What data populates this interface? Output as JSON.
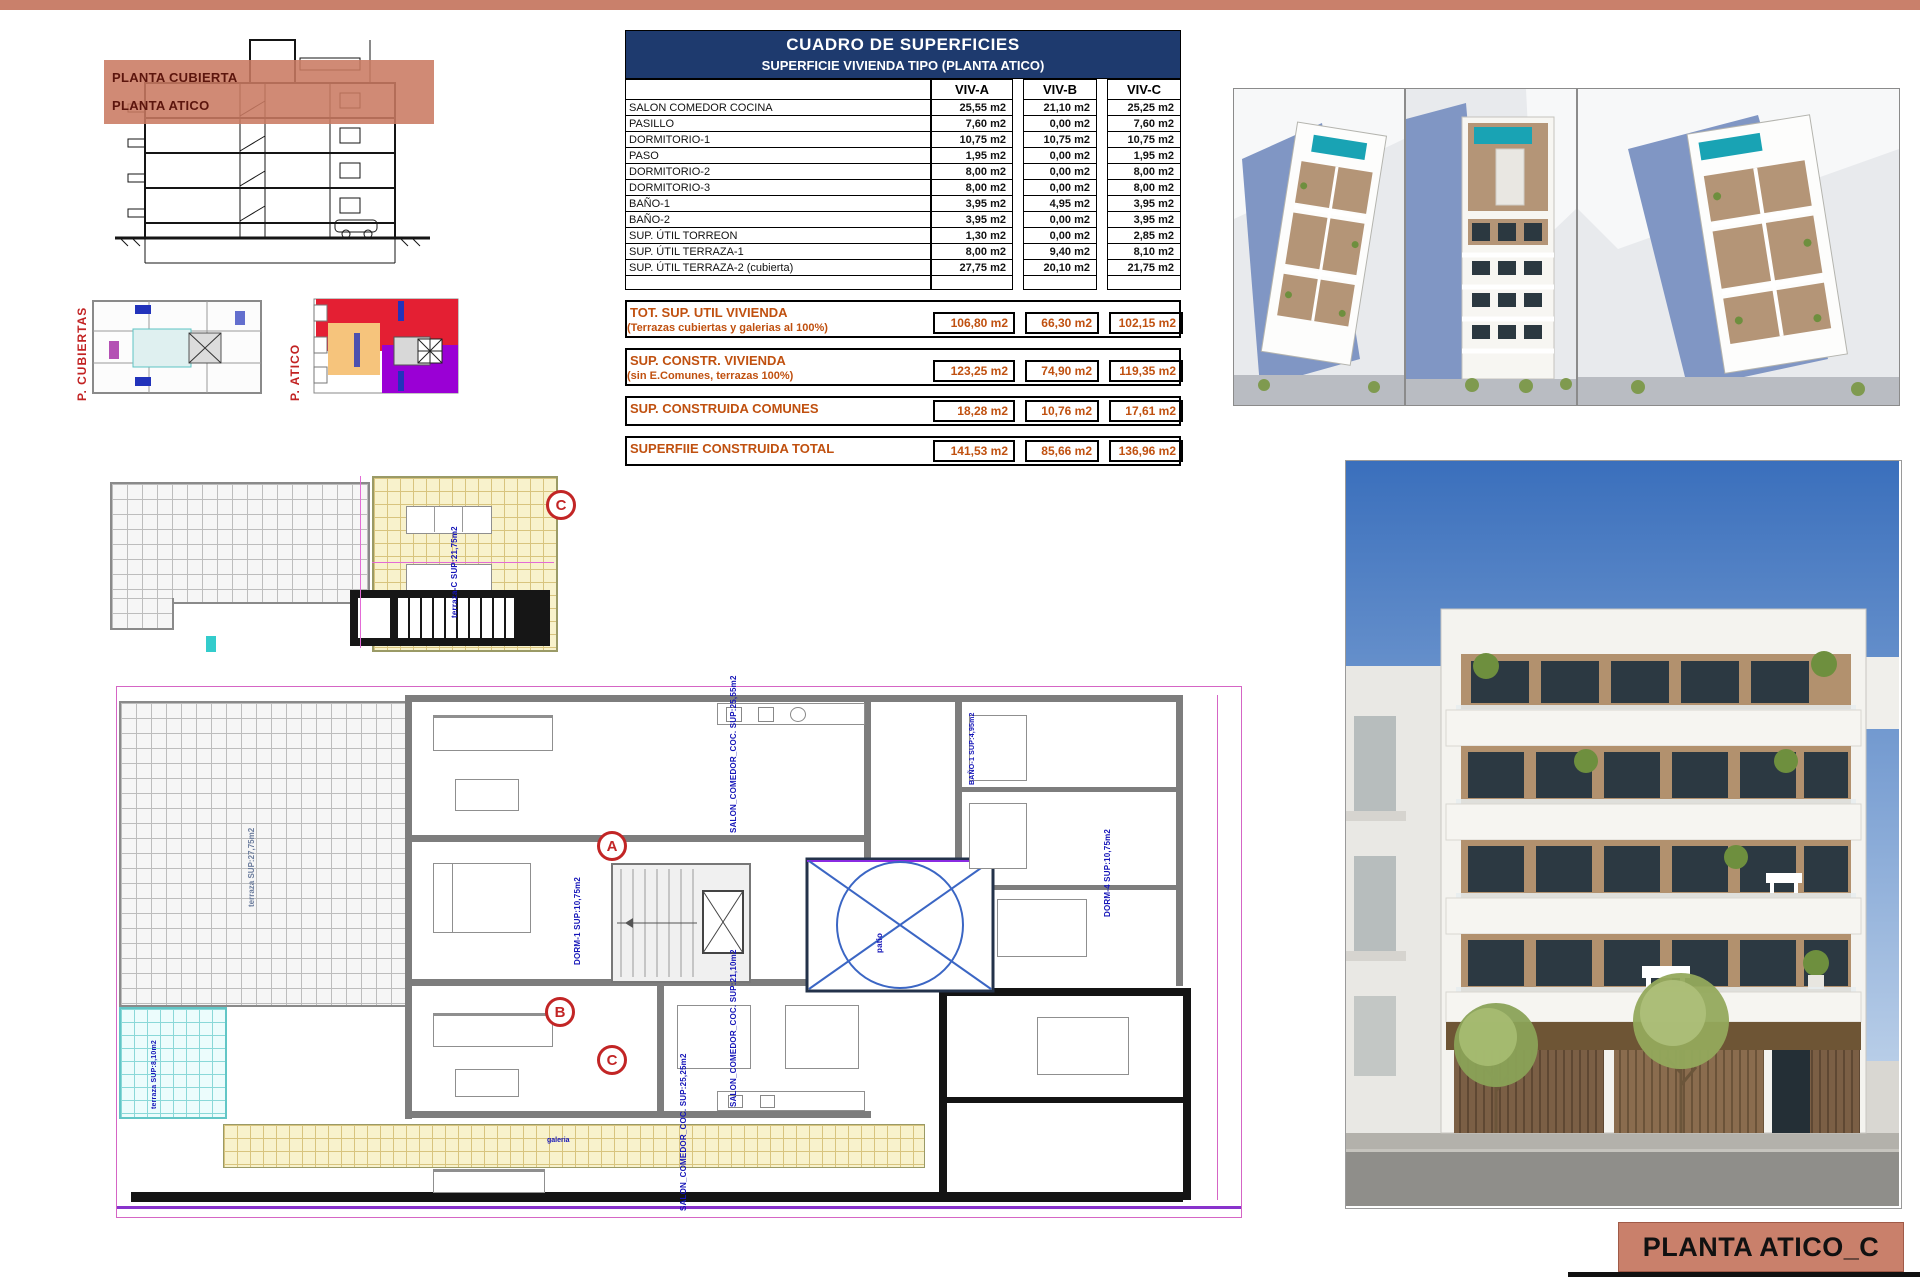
{
  "page": {
    "footer_label": "PLANTA ATICO_C"
  },
  "section_panel": {
    "band_labels": [
      "PLANTA CUBIERTA",
      "PLANTA ATICO"
    ]
  },
  "key_plans": {
    "left_label": "P. CUBIERTAS",
    "right_label": "P. ATICO"
  },
  "surface_table": {
    "title": "CUADRO DE SUPERFICIES",
    "subtitle": "SUPERFICIE VIVIENDA TIPO  (PLANTA ATICO)",
    "columns": [
      "VIV-A",
      "VIV-B",
      "VIV-C"
    ],
    "rows": [
      {
        "label": "SALON COMEDOR COCINA",
        "a": "25,55 m2",
        "b": "21,10 m2",
        "c": "25,25 m2"
      },
      {
        "label": "PASILLO",
        "a": "7,60 m2",
        "b": "0,00 m2",
        "c": "7,60 m2"
      },
      {
        "label": "DORMITORIO-1",
        "a": "10,75 m2",
        "b": "10,75 m2",
        "c": "10,75 m2"
      },
      {
        "label": "PASO",
        "a": "1,95 m2",
        "b": "0,00 m2",
        "c": "1,95 m2"
      },
      {
        "label": "DORMITORIO-2",
        "a": "8,00 m2",
        "b": "0,00 m2",
        "c": "8,00 m2"
      },
      {
        "label": "DORMITORIO-3",
        "a": "8,00 m2",
        "b": "0,00 m2",
        "c": "8,00 m2"
      },
      {
        "label": "BAÑO-1",
        "a": "3,95 m2",
        "b": "4,95 m2",
        "c": "3,95 m2"
      },
      {
        "label": "BAÑO-2",
        "a": "3,95 m2",
        "b": "0,00 m2",
        "c": "3,95 m2"
      },
      {
        "label": "SUP. ÚTIL TORREON",
        "a": "1,30 m2",
        "b": "0,00 m2",
        "c": "2,85 m2"
      },
      {
        "label": "SUP. ÚTIL TERRAZA-1",
        "a": "8,00 m2",
        "b": "9,40 m2",
        "c": "8,10 m2"
      },
      {
        "label": "SUP. ÚTIL TERRAZA-2 (cubierta)",
        "a": "27,75 m2",
        "b": "20,10 m2",
        "c": "21,75 m2"
      }
    ],
    "summary": [
      {
        "label": "TOT. SUP. UTIL VIVIENDA",
        "note": "(Terrazas cubiertas y galerias al 100%)",
        "a": "106,80 m2",
        "b": "66,30 m2",
        "c": "102,15 m2"
      },
      {
        "label": "SUP. CONSTR. VIVIENDA",
        "note": "(sin E.Comunes, terrazas 100%)",
        "a": "123,25 m2",
        "b": "74,90 m2",
        "c": "119,35 m2"
      },
      {
        "label": "SUP. CONSTRUIDA COMUNES",
        "note": "",
        "a": "18,28 m2",
        "b": "10,76 m2",
        "c": "17,61 m2"
      },
      {
        "label": "SUPERFIIE CONSTRUIDA TOTAL",
        "note": "",
        "a": "141,53 m2",
        "b": "85,66 m2",
        "c": "136,96 m2"
      }
    ]
  },
  "roof_plan": {
    "marker": "C",
    "label": "terraza-C SUP:21,75m2"
  },
  "floor_plan": {
    "markers": [
      "A",
      "B",
      "C"
    ],
    "labels": {
      "salon_a": "SALON_COMEDOR_COC. SUP:25,55m2",
      "dorm1": "DORM-1 SUP:10,75m2",
      "bano1": "BAÑO-1 SUP:4,95m2",
      "salon_b": "SALON_COMEDOR_COC. SUP:21,10m2",
      "salon_c": "SALON_COMEDOR_COC. SUP:25,25m2",
      "dorm4": "DORM-4 SUP:10,75m2",
      "patio": "patio",
      "galeria": "galeria",
      "terraza_big": "terraza SUP:27,75m2",
      "terraza_cyan": "terraza SUP:8,10m2"
    }
  },
  "colors": {
    "accent_salmon": "#c9806b",
    "table_header_navy": "#1e3a6e",
    "summary_orange": "#c0500f",
    "marker_red": "#c22525",
    "patio_blue": "#3b66c4"
  }
}
